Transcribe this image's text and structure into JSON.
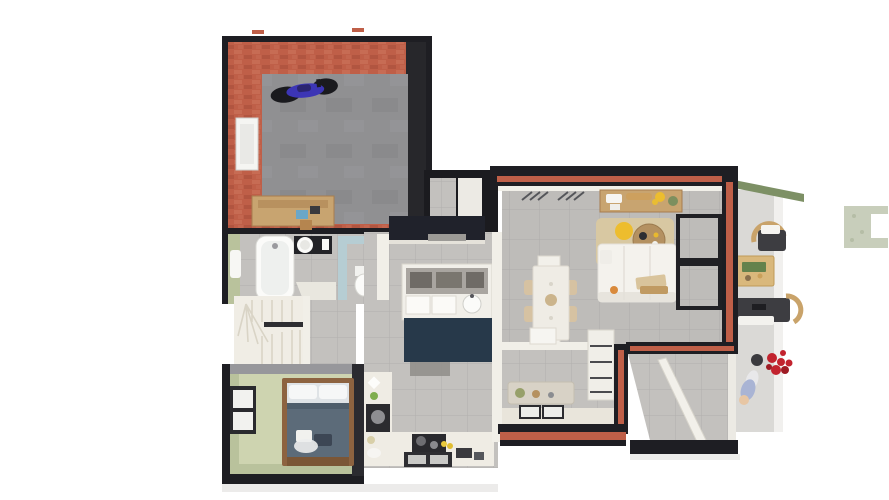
{
  "app": {
    "type": "3d-floorplan-render",
    "description": "Top-down 3D rendered floor plan of a single-storey house with garage, bathroom, WC, staircase, bedroom, kitchen, living-dining room, entry hall, porch and terrace"
  },
  "colors": {
    "wall_dark": "#1e1e23",
    "wall_dark2": "#2b2b30",
    "brick": "#bf5f48",
    "brick_light": "#d07c62",
    "brick_dark": "#a04936",
    "garage_floor": "#909092",
    "garage_floor_dark": "#7e7e81",
    "tile": "#c3c1be",
    "tile_line": "#b2b0ad",
    "living_floor": "#bebcb9",
    "cream_floor": "#e9e5db",
    "white_wall": "#f1efe8",
    "stairs": "#f0ede5",
    "stair_line": "#d9d4c6",
    "sage_wall": "#b9c29c",
    "sage_floor": "#ced4b0",
    "teal_wall": "#b6cdd3",
    "navy_cabinet": "#20222b",
    "navy_floor": "#27394a",
    "counter": "#efece4",
    "appliance_dark": "#2a2a2e",
    "wood": "#c8a470",
    "wood_dark": "#a77d4e",
    "bed_wood": "#8d6340",
    "blanket": "#5c6b79",
    "white_furniture": "#f4f2ed",
    "rug": "#d9c8a0",
    "pouf": "#edbd2e",
    "hedge": "#7d9065",
    "grass": "#c8cebb",
    "flower_red": "#c2232e",
    "outdoor_dark": "#3d3d41",
    "outdoor_wood": "#c9a36a",
    "shadow": "#e4e3e1",
    "moto_blue": "#3c35b5",
    "moto_dark": "#1a1a1e",
    "porcelain": "#fbfbf9"
  },
  "rooms": [
    {
      "id": "garage",
      "label": "Garage",
      "walls": "red brick",
      "floor": "concrete",
      "items": [
        "motorcycle",
        "workbench",
        "window"
      ]
    },
    {
      "id": "bathroom",
      "label": "Bathroom",
      "items": [
        "bathtub",
        "vanity with round basin",
        "towel",
        "shower tray"
      ]
    },
    {
      "id": "wc",
      "label": "WC",
      "walls": "light blue",
      "items": [
        "toilet"
      ]
    },
    {
      "id": "staircase",
      "label": "Staircase",
      "items": [
        "winder stairs",
        "handrail"
      ]
    },
    {
      "id": "hallway",
      "label": "Hallway",
      "items": []
    },
    {
      "id": "bedroom",
      "label": "Bedroom",
      "walls": "sage green",
      "items": [
        "double bed",
        "window"
      ]
    },
    {
      "id": "kitchen",
      "label": "Kitchen",
      "items": [
        "dark tall cabinets",
        "island with sink",
        "cooktop",
        "double sink",
        "L-shaped counter"
      ]
    },
    {
      "id": "living-dining",
      "label": "Living / dining room",
      "items": [
        "dining table",
        "six chairs",
        "sofa",
        "round coffee tables",
        "yellow pouf",
        "jute rug",
        "sideboard",
        "glazed bay"
      ]
    },
    {
      "id": "entry",
      "label": "Entry hall",
      "items": [
        "bench",
        "doormats",
        "open door",
        "striped cabinet"
      ]
    },
    {
      "id": "porch",
      "label": "Porch",
      "items": [
        "open door"
      ]
    },
    {
      "id": "terrace",
      "label": "Terrace",
      "items": [
        "lounge chair",
        "wooden table",
        "outdoor bench",
        "red flower pot",
        "figure"
      ]
    },
    {
      "id": "garden",
      "label": "Garden",
      "items": [
        "hedge strip",
        "grass patch"
      ]
    }
  ]
}
